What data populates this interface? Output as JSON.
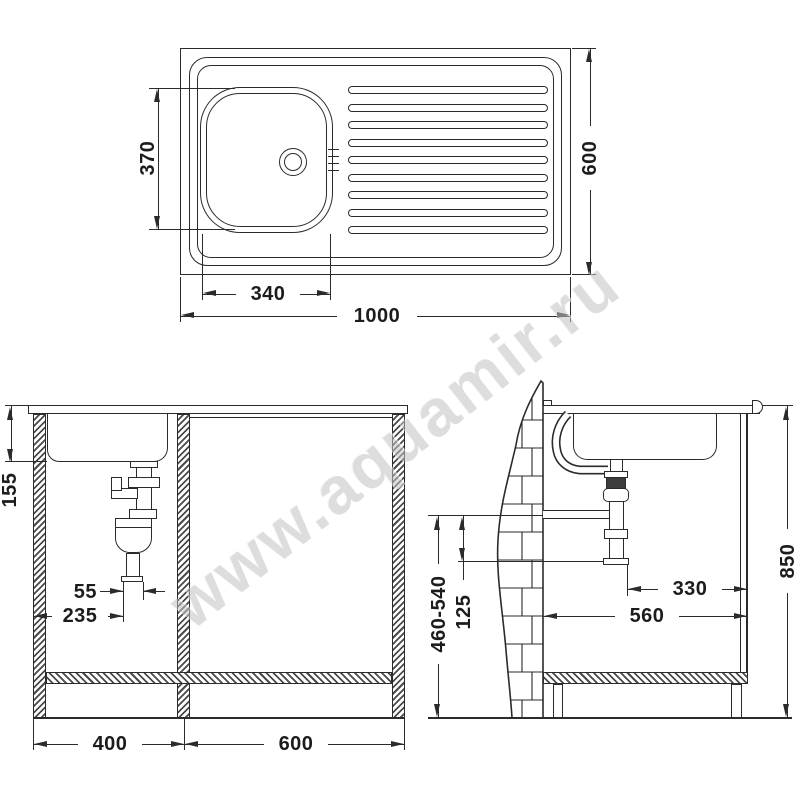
{
  "watermark": "www.aquamir.ru",
  "colors": {
    "line": "#2b2b2b",
    "text": "#1c1c1c",
    "watermark": "#c3c3c3"
  },
  "top_view": {
    "overall_width": "1000",
    "overall_depth": "600",
    "basin_width": "340",
    "basin_depth": "370"
  },
  "front_view": {
    "basin_depth": "155",
    "trap_offset": "55",
    "trap_from_wall": "235",
    "left_cabinet_width": "400",
    "right_cabinet_width": "600"
  },
  "side_view": {
    "waste_height_range": "460-540",
    "waste_drop": "125",
    "pipe_to_front": "330",
    "cabinet_depth": "560",
    "worktop_height": "850"
  }
}
